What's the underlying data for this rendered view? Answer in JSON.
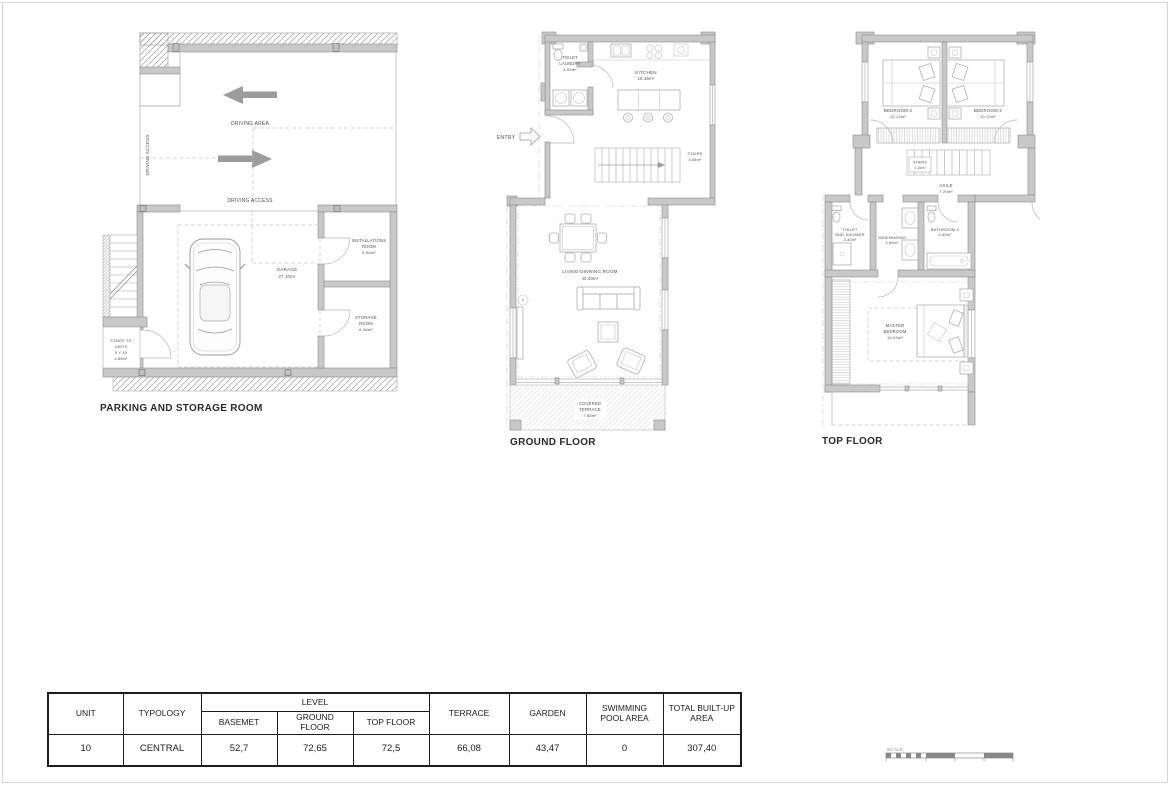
{
  "titles": {
    "parking": "PARKING AND STORAGE ROOM",
    "ground": "GROUND FLOOR",
    "top": "TOP FLOOR"
  },
  "colors": {
    "wall_fill": "#c8c8c8",
    "line_gray": "#9a9a9a",
    "label_gray": "#4f4f4f",
    "arrow_gray": "#9c9c9c",
    "table_border": "#1c1c1c"
  },
  "parking": {
    "driving_area": "DRIVING AREA",
    "driving_access_left": "DRIVING ACCESS",
    "driving_access_bottom": "DRIVING ACCESS",
    "garage": {
      "name": "GARAGE",
      "area": "27.10m²"
    },
    "installations": {
      "line1": "INSTALLATIONS",
      "line2": "ROOM",
      "area": "5.96m²"
    },
    "storage": {
      "line1": "STORAGE",
      "line2": "ROOM",
      "area": "6.08m²"
    },
    "stairs": {
      "line1": "STAIRS TO",
      "line2": "UNITS",
      "line3": "9 Y 10",
      "area": "4.88m²"
    }
  },
  "ground": {
    "entry": "ENTRY",
    "toilet_laundry": {
      "line1": "TOILET",
      "line2": "LAUNDRY",
      "area": "3.05m²"
    },
    "kitchen": {
      "name": "KITCHEN",
      "area": "16.19m²"
    },
    "stairs": {
      "name": "STAIRS",
      "area": "3.84m²"
    },
    "living": {
      "name": "LIVING-DINNING ROOM",
      "area": "40.30m²"
    },
    "terrace": {
      "line1": "COVERED",
      "line2": "TERRACE",
      "area": "7.58m²"
    }
  },
  "top": {
    "bedroom3": {
      "name": "BEDROOM 3",
      "area": "10.12m²"
    },
    "bedroom2": {
      "name": "BEDROOM 2",
      "area": "10.12m²"
    },
    "stairs": {
      "name": "STAIRS",
      "area": "1.10m²"
    },
    "aisle": {
      "name": "ASILE",
      "area": "7.20m²"
    },
    "toilet_shower": {
      "line1": "TOILET",
      "line2": "AND SHOWER",
      "area": "3.30m²"
    },
    "washbasins": {
      "name": "WASHBASINS",
      "area": "4.89m²"
    },
    "bathroom2": {
      "name": "BATHROOM 2",
      "area": "4.80m²"
    },
    "master": {
      "line1": "MASTER",
      "line2": "BEDROOM",
      "area": "19.03m²"
    }
  },
  "table": {
    "headers": {
      "unit": "UNIT",
      "typology": "TYPOLOGY",
      "level": "LEVEL",
      "basement": "BASEMET",
      "ground_floor": "GROUND FLOOR",
      "top_floor": "TOP FLOOR",
      "terrace": "TERRACE",
      "garden": "GARDEN",
      "swimming_pool": "SWIMMING POOL AREA",
      "total_built_up": "TOTAL BUILT-UP AREA"
    },
    "row": {
      "unit": "10",
      "typology": "CENTRAL",
      "basement": "52,7",
      "ground_floor": "72,65",
      "top_floor": "72,5",
      "terrace": "66,08",
      "garden": "43,47",
      "swimming_pool": "0",
      "total_built_up": "307,40"
    }
  },
  "scale": {
    "label": "SCALE"
  }
}
